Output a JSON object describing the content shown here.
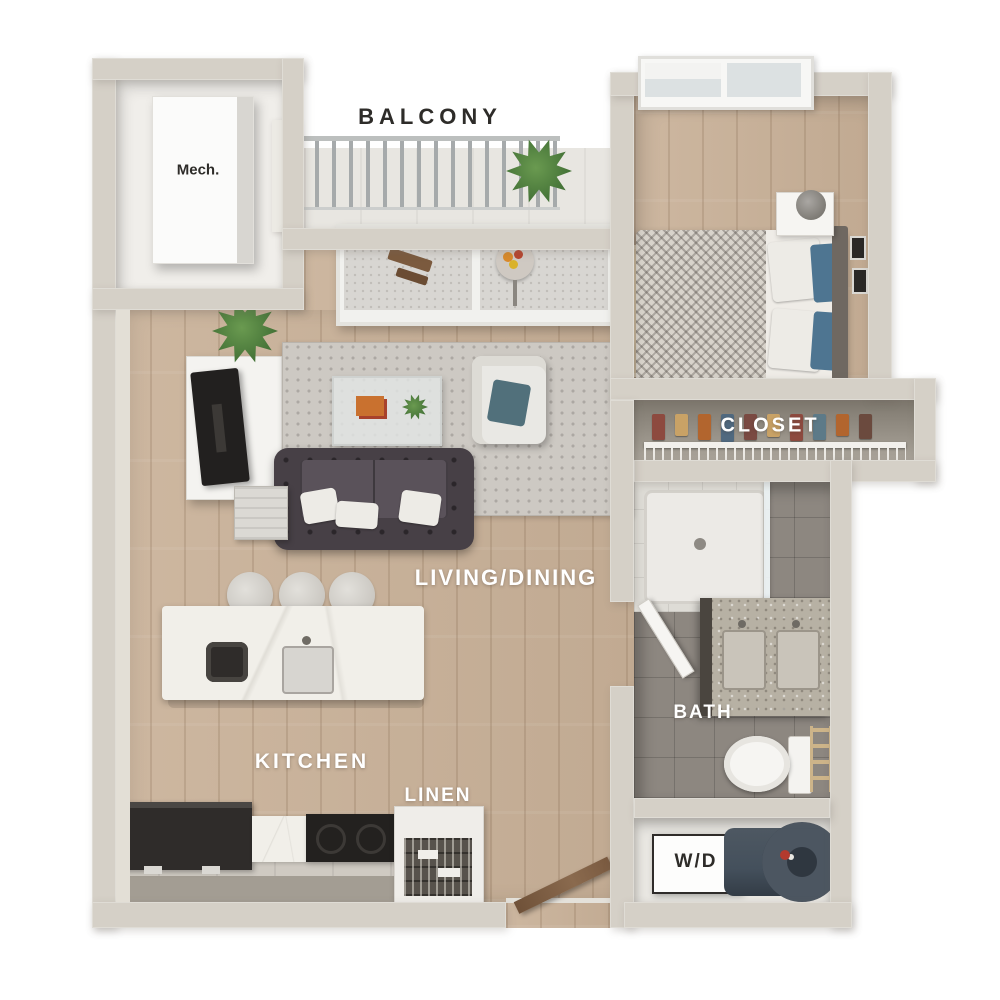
{
  "title": "3D one-bedroom apartment floor plan",
  "labels": {
    "balcony": "BALCONY",
    "mech": "Mech.",
    "closet": "CLOSET",
    "living_dining": "LIVING/DINING",
    "kitchen": "KITCHEN",
    "linen": "LINEN",
    "bath": "BATH",
    "washer_dryer": "W/D"
  },
  "colors": {
    "background": "#ffffff",
    "wall": "#d5d0c7",
    "wood_floor": "#c8b29b",
    "bath_tile": "#8d8780",
    "balcony_floor": "#e8e6e1",
    "rug": "#cdc9c3",
    "sofa": "#474046",
    "accent_blue": "#4e7591",
    "marble": "#f1efe9",
    "appliance_dark": "#2f2c2a",
    "plant_green": "#3e6c33",
    "water_heater": "#44505c",
    "label_light": "#ffffff",
    "label_dark": "#2e2c29"
  },
  "rooms": [
    {
      "name": "balcony",
      "furnishings": [
        "railing",
        "potted-plant",
        "bistro-table",
        "bistro-chair"
      ]
    },
    {
      "name": "mech-closet",
      "furnishings": [
        "mechanical-unit"
      ]
    },
    {
      "name": "bedroom",
      "furnishings": [
        "window",
        "bed",
        "blanket",
        "pillows",
        "nightstand",
        "lamp",
        "wall-frames",
        "rug"
      ]
    },
    {
      "name": "closet",
      "furnishings": [
        "wire-shelf",
        "hanging-clothes"
      ]
    },
    {
      "name": "living-dining",
      "furnishings": [
        "sliding-glass-doors",
        "tv-console",
        "tv",
        "potted-plant",
        "area-rug",
        "coffee-table",
        "armchair",
        "sofa",
        "side-table"
      ]
    },
    {
      "name": "kitchen",
      "furnishings": [
        "island",
        "bar-stools",
        "sink",
        "refrigerator",
        "range",
        "counter"
      ]
    },
    {
      "name": "linen-closet",
      "furnishings": [
        "wire-baskets"
      ]
    },
    {
      "name": "bath",
      "furnishings": [
        "shower",
        "vanity",
        "double-sinks",
        "toilet",
        "towel-ladder",
        "door"
      ]
    },
    {
      "name": "laundry-closet",
      "furnishings": [
        "washer-dryer",
        "water-heater"
      ]
    },
    {
      "name": "entry",
      "furnishings": [
        "entry-door"
      ]
    }
  ]
}
